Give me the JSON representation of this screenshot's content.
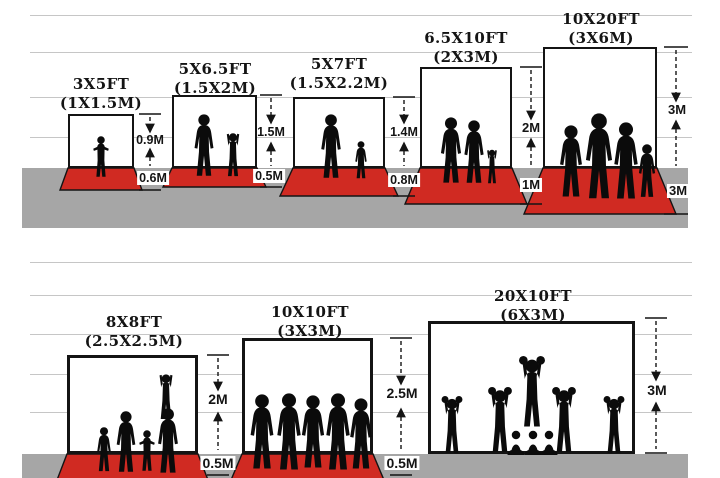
{
  "figure": {
    "type": "backdrop-size-comparison-diagram",
    "colors": {
      "carpet": "#d02a22",
      "ground": "#a6a6a6",
      "ruled_line": "#c6c6c6",
      "ink": "#141414"
    },
    "rows": [
      {
        "name": "small-backdrops",
        "panels": [
          {
            "title": "3X5FT",
            "subtitle": "(1X1.5M)",
            "height_label": "0.9M",
            "floor_label": "0.6M",
            "silhouette": "toddler-girl"
          },
          {
            "title": "5X6.5FT",
            "subtitle": "(1.5X2M)",
            "height_label": "1.5M",
            "floor_label": "0.5M",
            "silhouette": "mother-and-child"
          },
          {
            "title": "5X7FT",
            "subtitle": "(1.5X2.2M)",
            "height_label": "1.4M",
            "floor_label": "0.8M",
            "silhouette": "father-and-son"
          },
          {
            "title": "6.5X10FT",
            "subtitle": "(2X3M)",
            "height_label": "2M",
            "floor_label": "1M",
            "silhouette": "couple-with-child"
          },
          {
            "title": "10X20FT",
            "subtitle": "(3X6M)",
            "height_label": "3M",
            "floor_label": "3M",
            "silhouette": "family-of-four"
          }
        ]
      },
      {
        "name": "large-backdrops",
        "panels": [
          {
            "title": "8X8FT",
            "subtitle": "(2.5X2.5M)",
            "height_label": "2M",
            "floor_label": "0.5M",
            "silhouette": "family-group-with-cheer"
          },
          {
            "title": "10X10FT",
            "subtitle": "(3X3M)",
            "height_label": "2.5M",
            "floor_label": "0.5M",
            "silhouette": "team-of-five"
          },
          {
            "title": "20X10FT",
            "subtitle": "(6X3M)",
            "height_label": "3M",
            "floor_label": "",
            "silhouette": "cheerleading-squad"
          }
        ]
      }
    ]
  }
}
